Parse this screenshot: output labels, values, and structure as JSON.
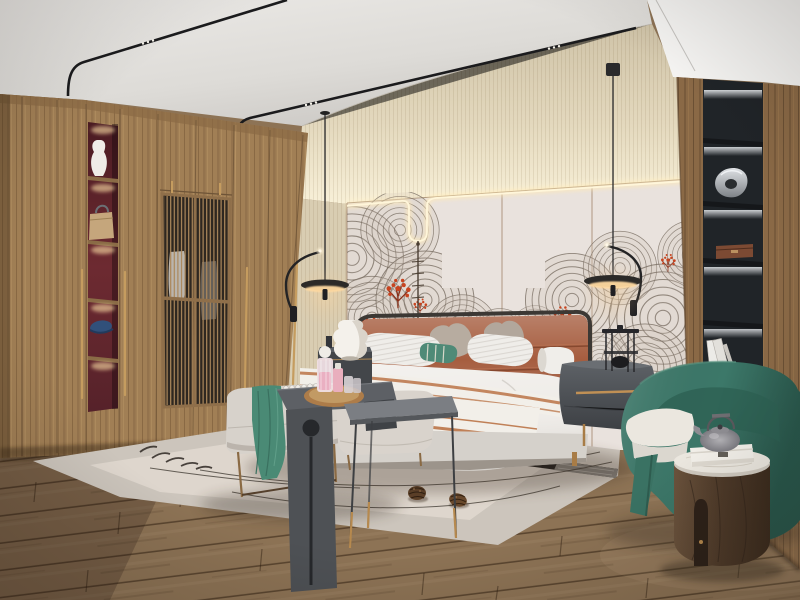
{
  "scene": {
    "kind": "interior-photo-render",
    "room": "bedroom",
    "style": "modern new-chinese",
    "no_visible_text": true
  },
  "palette": {
    "ceiling": "#e6e4e1",
    "ceiling_deep": "#cfccc8",
    "beam_white": "#f5f4f2",
    "cove_beige_top": "#d6cab0",
    "cove_beige_glow": "#f8f0d8",
    "wall_panel": "#e9e2dd",
    "panel_seam": "#a2866c",
    "led_warm": "#fff3d2",
    "mural_line": "#7b6f64",
    "coral_red": "#c8441f",
    "wardrobe_wood": "#a17f55",
    "wardrobe_frame": "#6e5437",
    "niche_red": "#6d2a31",
    "lattice_dark": "#2e2720",
    "brass": "#c59c5f",
    "right_wall_wood": "#8a6946",
    "shelf_black": "#202428",
    "shelf_led": "#e9edf2",
    "floor_wood": "#8d7355",
    "floor_gap": "#3a2817",
    "rug_outer": "#ccc5bc",
    "rug_inner": "#ded7cd",
    "rug_band_dark": "#1f1e1c",
    "bedding_white": "#efece8",
    "bed_base": "#d5d1cb",
    "headboard_leather": "#a65d3f",
    "headboard_rail": "#3c3834",
    "pillow_gray": "#b5aaa0",
    "pillow_teal": "#4f8a77",
    "runner_stripe": "#c08057",
    "bench_fabric": "#d7d2cb",
    "console_dark": "#4e5155",
    "metal_table": "#7b7e83",
    "throw_green": "#4a8a75",
    "armchair_green": "#3c7869",
    "side_table_wood": "#54402f",
    "marble_top": "#ebe7df",
    "nightstand_gray": "#4a4d51",
    "pendant_black": "#2c2a28",
    "lamp_glow": "#ffd9a0",
    "pinecone_brown": "#5f4128"
  },
  "objects": [
    {
      "id": "ceiling",
      "label": "white ceiling with curved black magnetic track lights"
    },
    {
      "id": "track-spotlights",
      "label": "tiny triple spot dots on black tracks"
    },
    {
      "id": "cove-wall",
      "label": "textured beige upper wall with LED cove glow"
    },
    {
      "id": "headboard-wall",
      "label": "pinkish-gray wall panels outlined by warm LED strip with U-shaped dip"
    },
    {
      "id": "mural",
      "label": "gray concentric fan/wave line-art mural with red coral sprigs"
    },
    {
      "id": "wardrobe",
      "label": "full-height walnut wardrobe with lattice doors"
    },
    {
      "id": "display-niche",
      "label": "red-backed lit niches holding vase, handbag and navy cap"
    },
    {
      "id": "bookshelf-column",
      "label": "black built-in shelf column with LED-lit niches, sculpture, box, books"
    },
    {
      "id": "pendant-lamps",
      "label": "pair of black disc pendant lamps with arc arms and warm under-glow"
    },
    {
      "id": "bed",
      "label": "upholstered bed, terracotta leather headboard, white duvet, striped runner"
    },
    {
      "id": "pillows",
      "label": "white striped, taupe, teal-striped lumbar pillows and bolster"
    },
    {
      "id": "nightstands",
      "label": "dark gray nightstands; gourd table lamp left, wire lantern right"
    },
    {
      "id": "bench-set",
      "label": "foot bench with green throw, bead garland, dark waterfall console, tray with pink perfume bottles, gray metal side table, pouf"
    },
    {
      "id": "rug",
      "label": "light area rug with thin ink curves, feather marks, two pinecones, dark edge band"
    },
    {
      "id": "armchair",
      "label": "teal-green barrel armchair with cream cushion"
    },
    {
      "id": "round-table",
      "label": "round dark-wood drum side table, marble top, white box and gray teapot"
    },
    {
      "id": "floor",
      "label": "diagonal brown oak plank flooring"
    }
  ]
}
